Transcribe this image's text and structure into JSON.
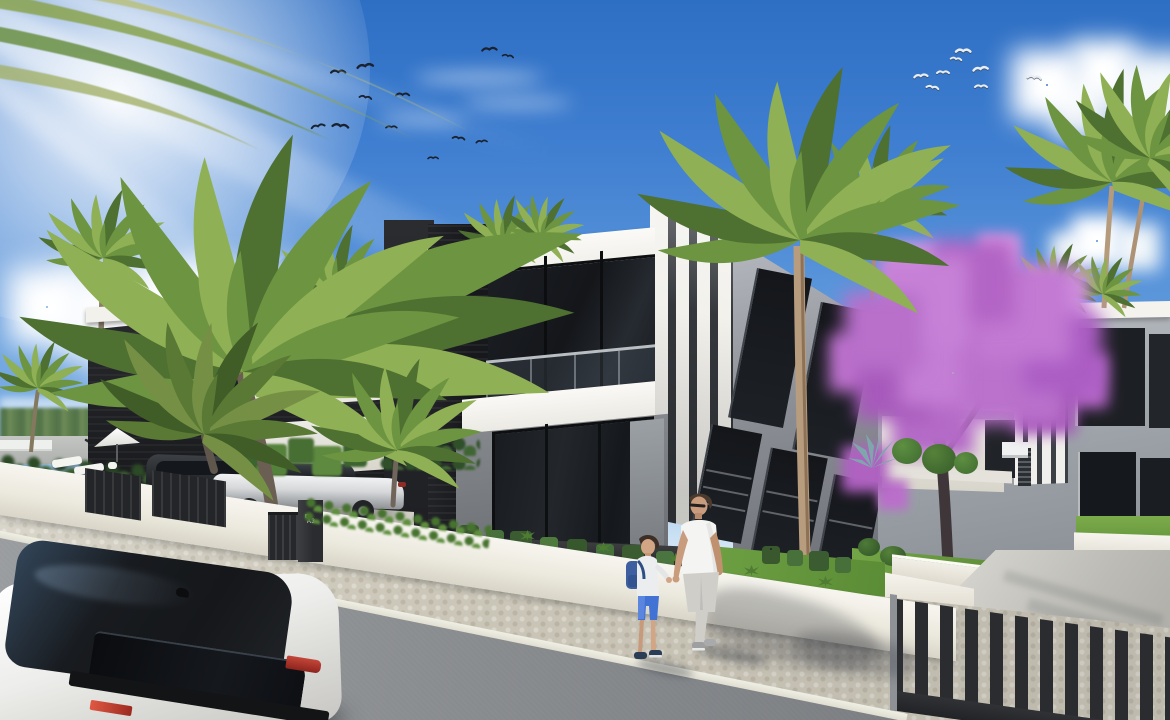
{
  "scene": {
    "setting": "modern-villa-exterior-render",
    "sign": {
      "label": "A3"
    },
    "birds": {
      "left_flock_count": 12,
      "right_flock_count": 8
    },
    "people": [
      {
        "name": "man-walking"
      },
      {
        "name": "boy-with-backpack"
      }
    ],
    "vehicles": [
      {
        "name": "white-suv-foreground",
        "body": "#f1f0ed",
        "roof": "#1a1c1f",
        "taillight": "#b8362c"
      },
      {
        "name": "silver-sedan-driveway",
        "body": "#d8d9db"
      },
      {
        "name": "dark-suv-driveway",
        "body": "#26282b"
      }
    ],
    "palette": {
      "sky_top": "#2e6fc4",
      "sky_horizon": "#e8f2fa",
      "cloud": "#ffffff",
      "facade_dark": "#232428",
      "facade_white": "#f4f3ef",
      "facade_gray": "#9aa0a6",
      "glass": "#17191d",
      "blossom_purple": "#bb76cc",
      "palm_green": "#6d9440",
      "lawn_green": "#74a546",
      "wall_white": "#f3f1ea",
      "fence_dark": "#27292c",
      "road_asphalt": "#84878a",
      "sidewalk_paver": "#ccc7b8",
      "curb": "#e9e7db"
    }
  }
}
